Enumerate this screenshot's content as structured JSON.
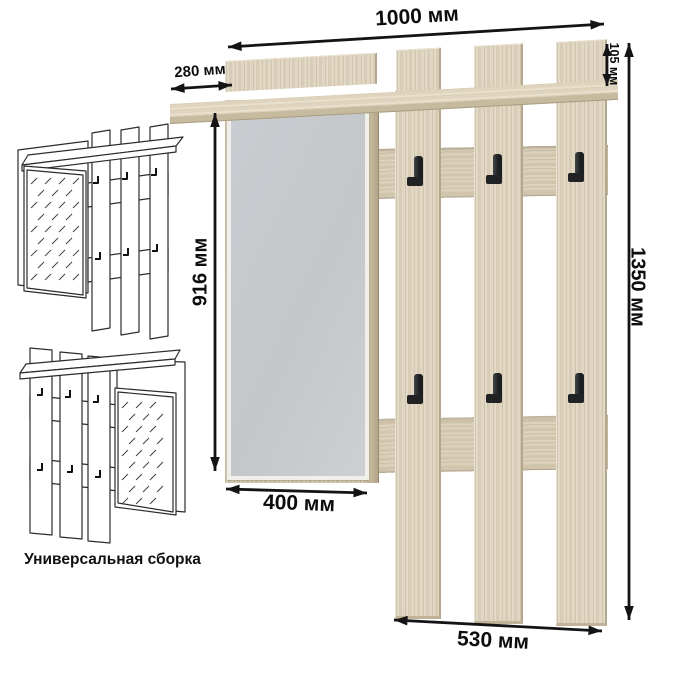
{
  "diagram": {
    "caption": "Универсальная сборка",
    "dimensions": {
      "total_width": "1000 мм",
      "shelf_depth": "280 мм",
      "top_panel_height": "105 мм",
      "total_height": "1350 мм",
      "mirror_height": "916 мм",
      "mirror_width": "400 мм",
      "slat_section_width": "530 мм"
    },
    "hooks_count": 6,
    "colors": {
      "wood": "#dcd2bd",
      "wood_edge": "#b3a78d",
      "mirror": "#c7cacd",
      "hook": "#232527",
      "dimension_line": "#141414",
      "background": "#ffffff"
    }
  }
}
